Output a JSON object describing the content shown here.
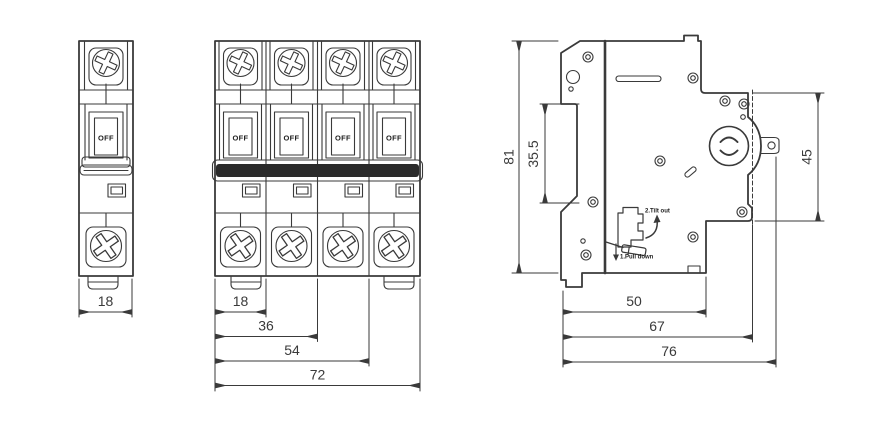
{
  "drawing": {
    "background": "#ffffff",
    "line_color": "#3a3a3a",
    "tie_bar_color": "#2b2b2b",
    "views": {
      "single_pole": {
        "switch_state": "OFF",
        "dims": {
          "width": "18"
        }
      },
      "four_pole": {
        "switch_states": [
          "OFF",
          "OFF",
          "OFF",
          "OFF"
        ],
        "dims": {
          "pole1": "18",
          "pole2": "36",
          "pole3": "54",
          "total": "72"
        }
      },
      "side": {
        "dims": {
          "height": "81",
          "din_slot": "35.5",
          "front_height": "45",
          "depth1": "50",
          "depth2": "67",
          "depth3": "76"
        },
        "annotations": {
          "step2": "2.Tilt out",
          "step1": "1.Pull down"
        }
      }
    }
  }
}
